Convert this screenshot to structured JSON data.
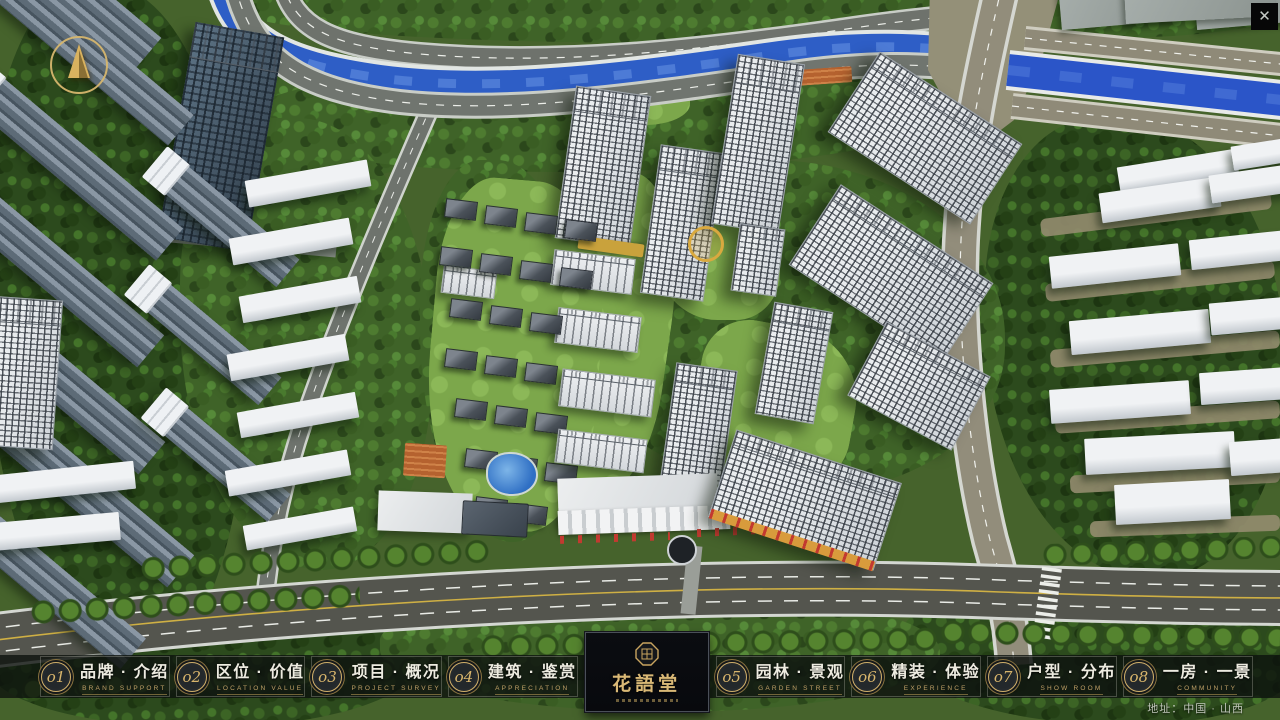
{
  "window": {
    "close_glyph": "✕"
  },
  "menu": {
    "items": [
      {
        "num": "o1",
        "zh": "品牌 · 介绍",
        "en": "BRAND SUPPORT"
      },
      {
        "num": "o2",
        "zh": "区位 · 价值",
        "en": "LOCATION VALUE"
      },
      {
        "num": "o3",
        "zh": "项目 · 概况",
        "en": "PROJECT SURVEY"
      },
      {
        "num": "o4",
        "zh": "建筑 · 鉴赏",
        "en": "APPRECIATION"
      },
      {
        "num": "o5",
        "zh": "园林 · 景观",
        "en": "GARDEN STREET"
      },
      {
        "num": "o6",
        "zh": "精装 · 体验",
        "en": "EXPERIENCE"
      },
      {
        "num": "o7",
        "zh": "户型 · 分布",
        "en": "SHOW ROOM"
      },
      {
        "num": "o8",
        "zh": "一房 · 一景",
        "en": "COMMUNITY"
      }
    ]
  },
  "logo": {
    "title": "花語堂"
  },
  "footer": {
    "address": "地址：中国 · 山西"
  },
  "icons": {
    "close": "✕",
    "compass": "north-arrow",
    "seal": "octagon-seal"
  },
  "colors": {
    "gold_accent": "#c9a257",
    "bar_background": "rgba(13,17,14,0.8)",
    "river_blue": "#2b55c8",
    "foliage_green": "#3f6328",
    "road_asphalt": "#6e726c",
    "tower_white": "#e9ecee"
  }
}
